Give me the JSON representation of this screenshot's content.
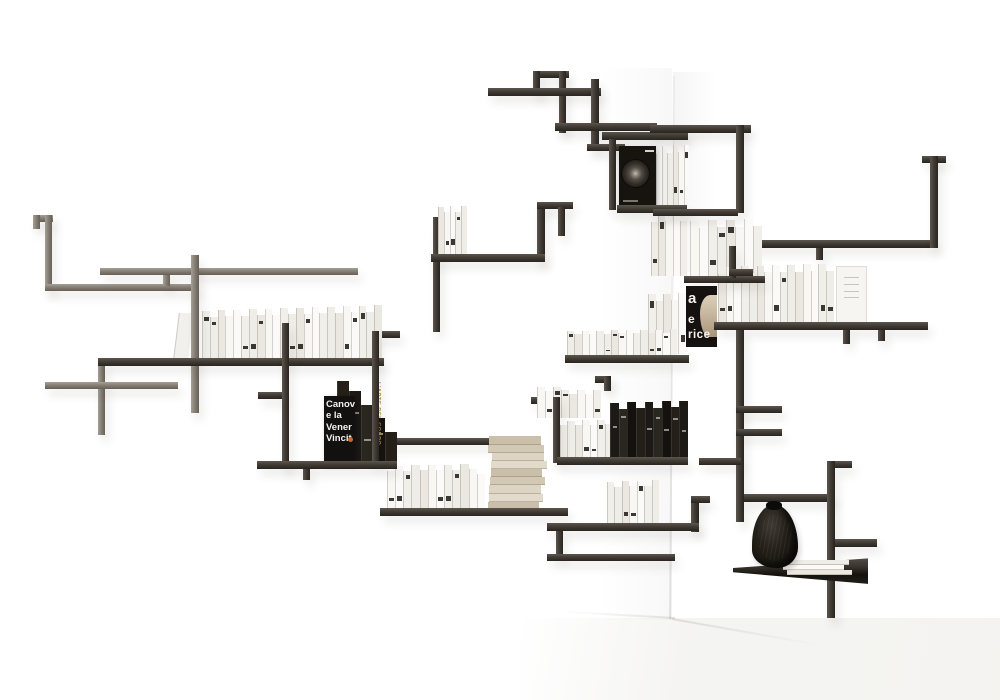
{
  "meta": {
    "description": "Product photo of a wall-mounted corner bookshelf sculpture made of thin dark metal rods arranged in rectilinear zigzags across two white walls, holding rows of white and black paperbacks, a flat lower shelf with a black crumpled vase and a small stack of white books."
  },
  "palette": {
    "rod_dark": "#423c36",
    "rod_light": "#847d74",
    "book_white": "#f5f3ef",
    "book_black": "#1c1917",
    "book_beige": "#d5cbb8",
    "vase_black": "#16130f",
    "accent_orange": "#c96b2f",
    "accent_gold": "#b9893e",
    "wall_white": "#ffffff"
  },
  "covers": {
    "canova": {
      "l1": "Canov",
      "l2": "e la",
      "l3": "Vener",
      "l4": "Vincit"
    },
    "statue": {
      "l1": "a",
      "l2": "e",
      "l3": "rice"
    },
    "gold_spine": "L'ARTE DEL CORPO"
  },
  "scene": {
    "rods": [
      {
        "x": 33,
        "y": 215,
        "w": 20,
        "h": 7,
        "t": "l"
      },
      {
        "x": 33,
        "y": 215,
        "w": 7,
        "h": 14,
        "t": "l"
      },
      {
        "x": 45,
        "y": 215,
        "w": 7,
        "h": 76,
        "t": "l"
      },
      {
        "x": 45,
        "y": 284,
        "w": 152,
        "h": 7,
        "t": "l"
      },
      {
        "x": 100,
        "y": 268,
        "w": 258,
        "h": 7,
        "t": "l"
      },
      {
        "x": 163,
        "y": 275,
        "w": 7,
        "h": 11,
        "t": "l"
      },
      {
        "x": 191,
        "y": 255,
        "w": 8,
        "h": 158,
        "t": "l",
        "f": 1
      },
      {
        "x": 98,
        "y": 358,
        "w": 286,
        "h": 8,
        "t": "d",
        "f": 1
      },
      {
        "x": 98,
        "y": 362,
        "w": 7,
        "h": 73,
        "t": "l"
      },
      {
        "x": 45,
        "y": 382,
        "w": 133,
        "h": 7,
        "t": "l"
      },
      {
        "x": 282,
        "y": 323,
        "w": 7,
        "h": 146,
        "t": "d",
        "f": 1
      },
      {
        "x": 258,
        "y": 392,
        "w": 26,
        "h": 7,
        "t": "d"
      },
      {
        "x": 356,
        "y": 331,
        "w": 44,
        "h": 7,
        "t": "d"
      },
      {
        "x": 372,
        "y": 331,
        "w": 7,
        "h": 133,
        "t": "d",
        "f": 1
      },
      {
        "x": 257,
        "y": 461,
        "w": 140,
        "h": 8,
        "t": "d",
        "f": 1
      },
      {
        "x": 303,
        "y": 468,
        "w": 7,
        "h": 12,
        "t": "d"
      },
      {
        "x": 380,
        "y": 438,
        "w": 123,
        "h": 7,
        "t": "d"
      },
      {
        "x": 433,
        "y": 217,
        "w": 7,
        "h": 115,
        "t": "d"
      },
      {
        "x": 431,
        "y": 254,
        "w": 114,
        "h": 8,
        "t": "d",
        "f": 1
      },
      {
        "x": 537,
        "y": 202,
        "w": 8,
        "h": 60,
        "t": "d"
      },
      {
        "x": 537,
        "y": 202,
        "w": 36,
        "h": 7,
        "t": "d"
      },
      {
        "x": 558,
        "y": 207,
        "w": 7,
        "h": 29,
        "t": "d"
      },
      {
        "x": 533,
        "y": 71,
        "w": 36,
        "h": 7,
        "t": "d"
      },
      {
        "x": 533,
        "y": 71,
        "w": 7,
        "h": 25,
        "t": "d"
      },
      {
        "x": 559,
        "y": 71,
        "w": 7,
        "h": 62,
        "t": "d"
      },
      {
        "x": 488,
        "y": 88,
        "w": 113,
        "h": 8,
        "t": "d"
      },
      {
        "x": 591,
        "y": 79,
        "w": 8,
        "h": 69,
        "t": "d"
      },
      {
        "x": 555,
        "y": 123,
        "w": 102,
        "h": 8,
        "t": "d"
      },
      {
        "x": 602,
        "y": 132,
        "w": 86,
        "h": 8,
        "t": "d"
      },
      {
        "x": 587,
        "y": 144,
        "w": 38,
        "h": 7,
        "t": "d"
      },
      {
        "x": 609,
        "y": 139,
        "w": 7,
        "h": 71,
        "t": "d"
      },
      {
        "x": 617,
        "y": 205,
        "w": 70,
        "h": 8,
        "t": "d",
        "f": 1
      },
      {
        "x": 650,
        "y": 125,
        "w": 101,
        "h": 8,
        "t": "d"
      },
      {
        "x": 736,
        "y": 125,
        "w": 8,
        "h": 88,
        "t": "d"
      },
      {
        "x": 653,
        "y": 209,
        "w": 85,
        "h": 7,
        "t": "d",
        "f": 1
      },
      {
        "x": 684,
        "y": 276,
        "w": 81,
        "h": 7,
        "t": "d",
        "f": 1
      },
      {
        "x": 729,
        "y": 246,
        "w": 7,
        "h": 32,
        "t": "d",
        "f": 1
      },
      {
        "x": 729,
        "y": 269,
        "w": 24,
        "h": 7,
        "t": "d",
        "f": 1
      },
      {
        "x": 743,
        "y": 240,
        "w": 192,
        "h": 8,
        "t": "d"
      },
      {
        "x": 922,
        "y": 156,
        "w": 24,
        "h": 7,
        "t": "d"
      },
      {
        "x": 930,
        "y": 156,
        "w": 8,
        "h": 92,
        "t": "d"
      },
      {
        "x": 816,
        "y": 248,
        "w": 7,
        "h": 12,
        "t": "d"
      },
      {
        "x": 714,
        "y": 322,
        "w": 214,
        "h": 8,
        "t": "d",
        "f": 1
      },
      {
        "x": 843,
        "y": 330,
        "w": 7,
        "h": 14,
        "t": "d"
      },
      {
        "x": 878,
        "y": 330,
        "w": 7,
        "h": 11,
        "t": "d"
      },
      {
        "x": 565,
        "y": 355,
        "w": 124,
        "h": 8,
        "t": "d",
        "f": 1
      },
      {
        "x": 531,
        "y": 397,
        "w": 32,
        "h": 7,
        "t": "d"
      },
      {
        "x": 553,
        "y": 397,
        "w": 7,
        "h": 66,
        "t": "d",
        "f": 1
      },
      {
        "x": 595,
        "y": 376,
        "w": 16,
        "h": 7,
        "t": "d"
      },
      {
        "x": 604,
        "y": 376,
        "w": 7,
        "h": 15,
        "t": "d"
      },
      {
        "x": 557,
        "y": 457,
        "w": 131,
        "h": 8,
        "t": "d",
        "f": 1
      },
      {
        "x": 380,
        "y": 508,
        "w": 188,
        "h": 8,
        "t": "d",
        "f": 1
      },
      {
        "x": 547,
        "y": 523,
        "w": 152,
        "h": 8,
        "t": "d",
        "f": 1
      },
      {
        "x": 691,
        "y": 496,
        "w": 8,
        "h": 36,
        "t": "d"
      },
      {
        "x": 691,
        "y": 496,
        "w": 19,
        "h": 7,
        "t": "d"
      },
      {
        "x": 556,
        "y": 530,
        "w": 7,
        "h": 27,
        "t": "d"
      },
      {
        "x": 547,
        "y": 554,
        "w": 128,
        "h": 7,
        "t": "d"
      },
      {
        "x": 736,
        "y": 330,
        "w": 8,
        "h": 192,
        "t": "d"
      },
      {
        "x": 736,
        "y": 406,
        "w": 46,
        "h": 7,
        "t": "d"
      },
      {
        "x": 736,
        "y": 429,
        "w": 46,
        "h": 7,
        "t": "d"
      },
      {
        "x": 699,
        "y": 458,
        "w": 42,
        "h": 7,
        "t": "d"
      },
      {
        "x": 744,
        "y": 494,
        "w": 90,
        "h": 8,
        "t": "d"
      },
      {
        "x": 827,
        "y": 461,
        "w": 8,
        "h": 157,
        "t": "d"
      },
      {
        "x": 835,
        "y": 461,
        "w": 17,
        "h": 7,
        "t": "d"
      },
      {
        "x": 835,
        "y": 539,
        "w": 42,
        "h": 8,
        "t": "d"
      }
    ],
    "book_groups": [
      {
        "x": 176,
        "y": 303,
        "w": 15,
        "h": 56,
        "style": "lean",
        "count": 1
      },
      {
        "x": 202,
        "y": 304,
        "w": 180,
        "h": 57,
        "style": "white",
        "count": 23
      },
      {
        "x": 438,
        "y": 204,
        "w": 29,
        "h": 51,
        "style": "white",
        "count": 5
      },
      {
        "x": 656,
        "y": 139,
        "w": 33,
        "h": 68,
        "style": "white",
        "count": 6
      },
      {
        "x": 651,
        "y": 212,
        "w": 36,
        "h": 64,
        "style": "white",
        "count": 5
      },
      {
        "x": 690,
        "y": 215,
        "w": 72,
        "h": 63,
        "style": "white",
        "count": 8
      },
      {
        "x": 648,
        "y": 292,
        "w": 38,
        "h": 62,
        "style": "white",
        "count": 5
      },
      {
        "x": 718,
        "y": 262,
        "w": 116,
        "h": 62,
        "style": "white",
        "count": 15
      },
      {
        "x": 836,
        "y": 257,
        "w": 31,
        "h": 67,
        "style": "plain",
        "count": 1
      },
      {
        "x": 567,
        "y": 329,
        "w": 110,
        "h": 28,
        "style": "white",
        "count": 15
      },
      {
        "x": 537,
        "y": 387,
        "w": 64,
        "h": 31,
        "style": "white",
        "count": 8
      },
      {
        "x": 560,
        "y": 418,
        "w": 52,
        "h": 42,
        "style": "white",
        "count": 7
      },
      {
        "x": 610,
        "y": 396,
        "w": 78,
        "h": 63,
        "style": "black",
        "count": 9
      },
      {
        "x": 337,
        "y": 377,
        "w": 60,
        "h": 86,
        "style": "blackstep",
        "count": 5
      },
      {
        "x": 488,
        "y": 436,
        "w": 58,
        "h": 74,
        "style": "beige",
        "count": 9
      },
      {
        "x": 387,
        "y": 464,
        "w": 98,
        "h": 46,
        "style": "white",
        "count": 12
      },
      {
        "x": 607,
        "y": 477,
        "w": 52,
        "h": 49,
        "style": "white",
        "count": 7
      },
      {
        "x": 783,
        "y": 560,
        "w": 66,
        "h": 15,
        "style": "flat",
        "count": 3
      }
    ]
  }
}
